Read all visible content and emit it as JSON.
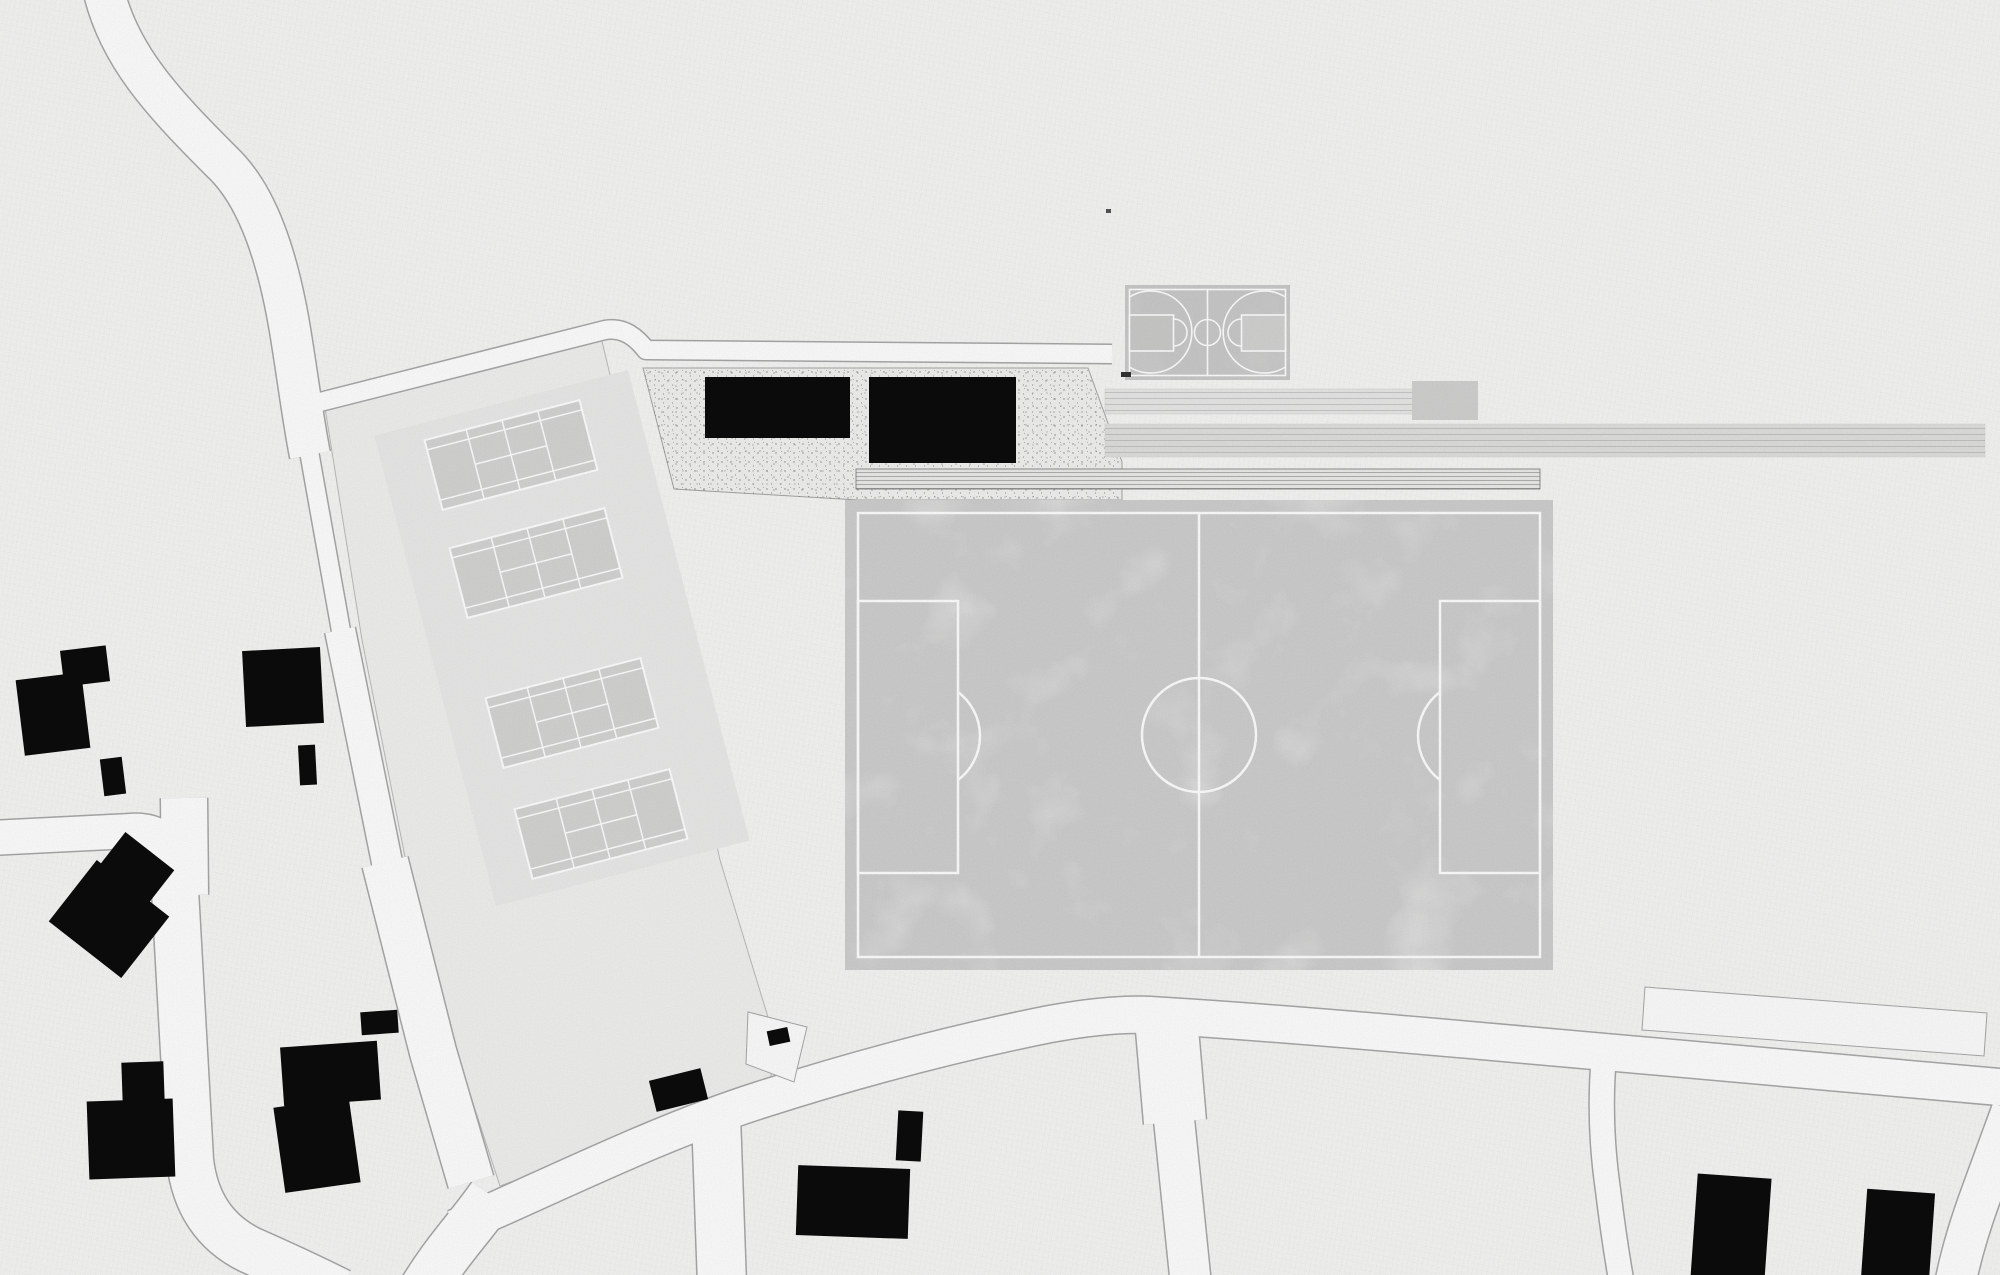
{
  "plan": {
    "name": "sports-park-site-plan",
    "colors": {
      "paper": "#f7f7f6",
      "road_fill": "#ffffff",
      "road_stroke": "#a9a9a9",
      "parcel": "#f1f1f0",
      "parcel_stroke": "#bcbcbb",
      "platform": "#ebebea",
      "plaza": "#f2f2f1",
      "plaza_stroke": "#a6a6a5",
      "field": "#ededec",
      "field_line": "#ffffff",
      "court": "#d5d5d4",
      "court_line": "#ffffff",
      "bb_court": "#d8d8d7",
      "bb_key_left": "#cbcbca",
      "bb_key_right": "#d3d3d2",
      "bb_line": "#ffffff",
      "strip1": "#e8e8e7",
      "strip_block": "#d2d2d1",
      "strip2": "#e0e0df",
      "band": "#ececeb",
      "band_stroke": "#787878",
      "building": "#0b0b0b",
      "white_plot": "#fdfdfd",
      "mark": "#555555"
    },
    "roads": [
      {
        "name": "road-north",
        "d": "M 103 -12 C 118 55 162 102 222 162 C 258 196 278 258 290 330 C 297 372 303 420 310 455",
        "w": 40
      },
      {
        "name": "road-tennis-west-upper",
        "d": "M 307 440 L 343 642",
        "w": 18
      },
      {
        "name": "road-tennis-west-mid",
        "d": "M 340 630 L 391 882",
        "w": 30
      },
      {
        "name": "road-tennis-west-lower",
        "d": "M 385 862 L 433 1052 L 471 1182",
        "w": 46
      },
      {
        "name": "road-tennis-north",
        "d": "M 320 402 L 605 330 Q 628 326 646 350 L 1112 354",
        "w": 18
      },
      {
        "name": "road-west-horizontal",
        "d": "M -10 838 L 130 831 Q 170 828 174 866 L 176 900",
        "w": 34
      },
      {
        "name": "road-west-stub",
        "d": "M 184 798 L 185 895",
        "w": 46
      },
      {
        "name": "road-west-vertical",
        "d": "M 175 890 L 190 1160 Q 197 1224 250 1250 Q 300 1272 340 1292",
        "w": 46
      },
      {
        "name": "road-main-diagonal",
        "d": "M 455 1228 C 560 1182 660 1132 760 1100 C 860 1068 960 1042 1050 1024 Q 1110 1013 1150 1015 C 1250 1021 1380 1032 1470 1040 C 1600 1051 1800 1070 2010 1088",
        "w": 36
      },
      {
        "name": "road-south-exit",
        "d": "M 492 1196 C 470 1228 445 1252 420 1295",
        "w": 48
      },
      {
        "name": "road-south-1",
        "d": "M 716 1116 L 722 1285",
        "w": 48
      },
      {
        "name": "road-south-2-upper",
        "d": "M 1166 1018 L 1175 1122",
        "w": 62
      },
      {
        "name": "road-south-2-lower",
        "d": "M 1172 1100 L 1191 1285",
        "w": 40
      },
      {
        "name": "road-southeast-sliver",
        "d": "M 1604 1056 Q 1598 1120 1608 1190 Q 1614 1240 1622 1285",
        "w": 24
      },
      {
        "name": "road-east-corner",
        "d": "M 2012 1110 L 1982 1192 Q 1962 1246 1954 1290",
        "w": 40
      }
    ],
    "areas": {
      "tennis_parcel": {
        "name": "tennis-parcel",
        "points": "325,408 600,333 622,425 672,640 720,860 775,1040 770,1086 500,1186 455,1048 408,872 362,640"
      },
      "platform": {
        "name": "tennis-platform",
        "cx": 562,
        "cy": 638,
        "w": 262,
        "h": 486,
        "rot": -14.5
      },
      "plaza": {
        "name": "gravel-plaza",
        "points": "643,368 1088,368 1122,462 1122,500 858,500 674,489"
      },
      "white_plot": {
        "name": "empty-plot",
        "points": "1645,987 1987,1013 1984,1056 1642,1030"
      },
      "notch_plot": {
        "name": "corner-plot",
        "points": "748,1012 807,1027 794,1082 746,1064"
      }
    },
    "band": {
      "name": "stepped-path",
      "x": 856,
      "y": 469,
      "w": 684,
      "h": 20
    },
    "strips": {
      "s1": {
        "name": "path-strip-short",
        "x": 1105,
        "y": 389,
        "w": 308,
        "h": 25
      },
      "block": {
        "name": "platform-block",
        "x": 1412,
        "y": 381,
        "w": 66,
        "h": 39
      },
      "s2": {
        "name": "path-strip-long",
        "x": 1105,
        "y": 424,
        "w": 880,
        "h": 33
      }
    },
    "soccer_field": {
      "name": "soccer-field",
      "x": 845,
      "y": 500,
      "w": 708,
      "h": 470,
      "inset": 13,
      "halfway_x": 1199,
      "center_cy": 735,
      "center_r": 57,
      "box_w": 100,
      "box_h": 272,
      "box_y": 601,
      "left_arc": "M 958 692 A 55 55 0 0 1 958 780",
      "right_arc": "M 1440 692 A 55 55 0 0 0 1440 780"
    },
    "basketball": {
      "name": "basketball-court",
      "x": 1125,
      "y": 285,
      "w": 165,
      "h": 95,
      "inner": {
        "x": 1129.5,
        "y": 289.5,
        "w": 156,
        "h": 86
      },
      "center_x": 1207.5,
      "center_cy": 332.5,
      "center_r": 13,
      "key_left": {
        "x": 1129.5,
        "y": 315,
        "w": 44,
        "h": 36
      },
      "key_right": {
        "x": 1241.5,
        "y": 315,
        "w": 44,
        "h": 36
      },
      "ft_arc_left": "M 1173.5 319 A 13.5 13.5 0 0 1 1173.5 346",
      "ft_arc_right": "M 1241.5 319 A 13.5 13.5 0 0 0 1241.5 346",
      "three_left": "M 1129.5 297 A 41 41 0 1 1 1129.5 367",
      "three_right": "M 1285.5 297 A 41 41 0 1 0 1285.5 367",
      "bench": {
        "x": 1121,
        "y": 372,
        "w": 10,
        "h": 5
      }
    },
    "tennis_courts": {
      "w": 160,
      "h": 72,
      "rot": -14.5,
      "centers": [
        [
          511,
          455
        ],
        [
          536,
          563
        ],
        [
          572,
          713
        ],
        [
          601,
          824
        ]
      ],
      "service_x": 37,
      "tram_y": 26
    },
    "buildings": [
      {
        "name": "house",
        "x": 62,
        "y": 648,
        "w": 46,
        "h": 36,
        "rot": -7
      },
      {
        "name": "house",
        "x": 20,
        "y": 676,
        "w": 66,
        "h": 76,
        "rot": -7
      },
      {
        "name": "shed",
        "x": 102,
        "y": 758,
        "w": 22,
        "h": 37,
        "rot": -7
      },
      {
        "name": "house",
        "x": 244,
        "y": 649,
        "w": 78,
        "h": 76,
        "rot": -3
      },
      {
        "name": "shed",
        "x": 299,
        "y": 745,
        "w": 17,
        "h": 40,
        "rot": -3
      },
      {
        "name": "house",
        "x": 101,
        "y": 845,
        "w": 62,
        "h": 58,
        "rot": 38
      },
      {
        "name": "house",
        "x": 63,
        "y": 880,
        "w": 92,
        "h": 78,
        "rot": 38
      },
      {
        "name": "house",
        "x": 122,
        "y": 1062,
        "w": 42,
        "h": 40,
        "rot": -2
      },
      {
        "name": "house",
        "x": 88,
        "y": 1100,
        "w": 86,
        "h": 78,
        "rot": -2
      },
      {
        "name": "shed",
        "x": 361,
        "y": 1011,
        "w": 37,
        "h": 23,
        "rot": -4
      },
      {
        "name": "house",
        "x": 282,
        "y": 1044,
        "w": 97,
        "h": 59,
        "rot": -4
      },
      {
        "name": "house",
        "x": 279,
        "y": 1102,
        "w": 76,
        "h": 86,
        "rot": -8
      },
      {
        "name": "house",
        "x": 797,
        "y": 1167,
        "w": 112,
        "h": 70,
        "rot": 2
      },
      {
        "name": "shed",
        "x": 897,
        "y": 1111,
        "w": 25,
        "h": 50,
        "rot": 3
      },
      {
        "name": "shed",
        "x": 652,
        "y": 1074,
        "w": 53,
        "h": 32,
        "rot": -14
      },
      {
        "name": "shed",
        "x": 768,
        "y": 1029,
        "w": 21,
        "h": 15,
        "rot": -12
      },
      {
        "name": "house",
        "x": 1694,
        "y": 1176,
        "w": 74,
        "h": 105,
        "rot": 4
      },
      {
        "name": "house",
        "x": 1864,
        "y": 1191,
        "w": 68,
        "h": 90,
        "rot": 4
      },
      {
        "name": "sports-hall",
        "x": 705,
        "y": 377,
        "w": 145,
        "h": 61,
        "rot": 0
      },
      {
        "name": "sports-hall",
        "x": 869,
        "y": 377,
        "w": 147,
        "h": 86,
        "rot": 0
      }
    ],
    "mark": {
      "name": "small-mark",
      "x": 1106,
      "y": 209,
      "w": 5,
      "h": 4
    }
  }
}
